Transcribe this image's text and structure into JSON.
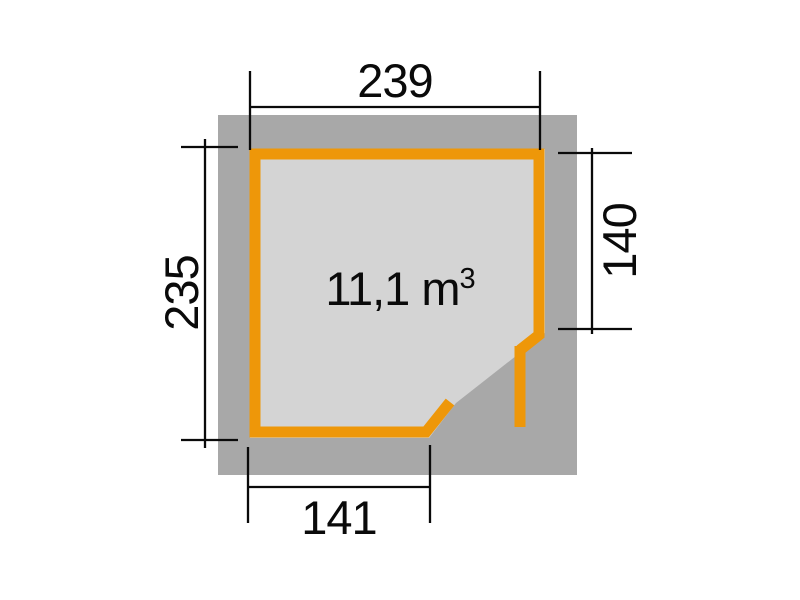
{
  "dimensions": {
    "top": "239",
    "left": "235",
    "right": "140",
    "bottom": "141"
  },
  "volume": {
    "text": "11,1 m",
    "exponent": "3"
  },
  "icons": {
    "wall_outline": "pentagon-floor-plan-with-corner-door",
    "door_leaf": "open-door-leaf-line"
  },
  "colors": {
    "background": "#ffffff",
    "roof_overhang": "#a8a8a8",
    "floor": "#d4d4d4",
    "wall_outline": "#ee9709",
    "dimension_line": "#0a0a0a",
    "dimension_text": "#0a0a0a"
  }
}
